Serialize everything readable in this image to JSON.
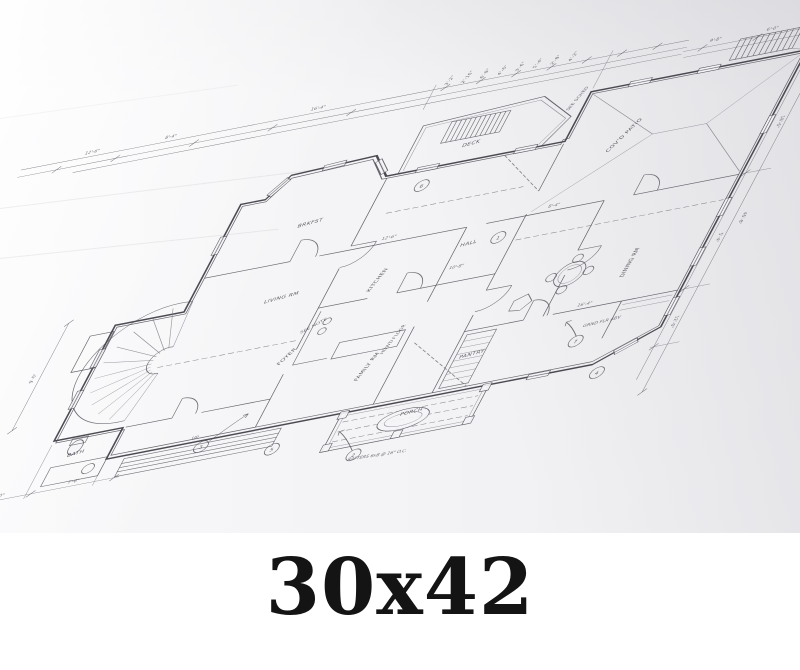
{
  "caption": {
    "size_label": "30x42"
  },
  "plan": {
    "ink_color": "#3c3c43",
    "paper_color": "#f3f3f5",
    "rooms": [
      "DECK",
      "COV'D PATIO",
      "BRKFST",
      "KITCHEN",
      "FAMILY RM",
      "DINING RM",
      "LIVING RM",
      "FOYER",
      "PANTRY",
      "PORCH",
      "HALL",
      "BATH"
    ],
    "notes": {
      "see_note": "SEE NOTE",
      "floor_note": "HDWD FLOOR",
      "grnd_note": "GRND FLR ABV",
      "rafter_note": "RAFTERS 6x8 @ 16\" O.C.",
      "up_note": "UP",
      "sched_note": "SEE SCHED"
    },
    "dims": [
      "3'-2\"",
      "2'-10\"",
      "6'-8\"",
      "4'-6\"",
      "3'-6\"",
      "5'-4\"",
      "2'-8\"",
      "4'-2\"",
      "9'-8\"",
      "6'-0\"",
      "12'-4\"",
      "18'-6\"",
      "5'-4\"",
      "12'-0\"",
      "46'-8\"",
      "4'-0\"",
      "7'-6\"",
      "9'-0\"",
      "12'-6\"",
      "8'-4\"",
      "16'-4\"",
      "10'-8\""
    ],
    "bubbles": [
      "3",
      "5",
      "2",
      "7",
      "4",
      "6",
      "1"
    ]
  }
}
